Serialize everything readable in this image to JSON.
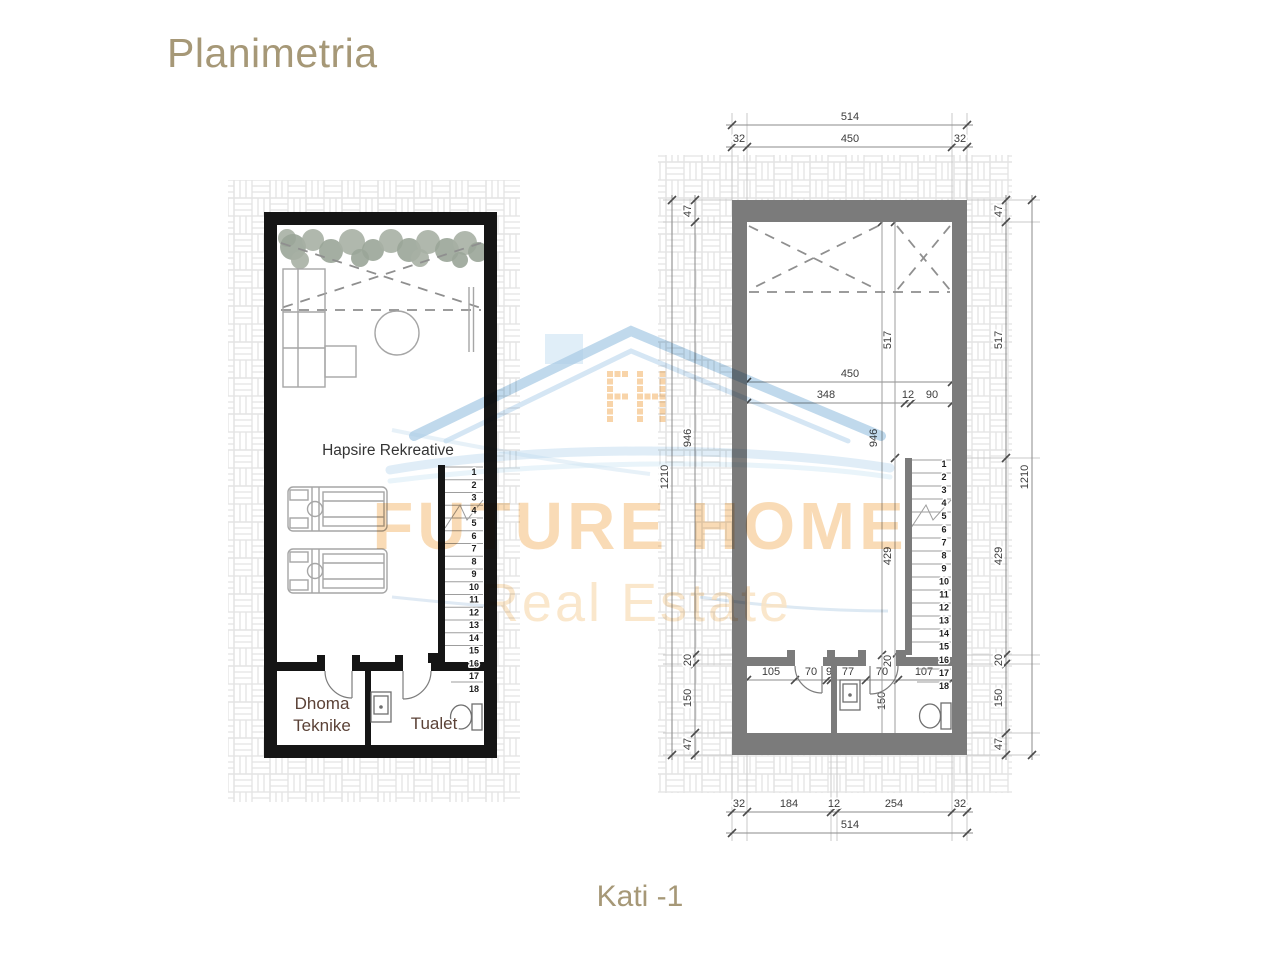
{
  "header": {
    "title": "Planimetria"
  },
  "footer": {
    "caption": "Kati -1"
  },
  "watermark": {
    "brand_line1": "FUTURE HOME",
    "brand_line2": "Real Estate",
    "logo": "fh-pixel-house-logo",
    "colors": {
      "orange": "#f5c48a",
      "blue": "#a3c7e3"
    }
  },
  "left_plan": {
    "room_main": "Hapsire Rekreative",
    "room_tech_line1": "Dhoma",
    "room_tech_line2": "Teknike",
    "room_toilet": "Tualet"
  },
  "stairs": {
    "numbers": [
      "1",
      "2",
      "3",
      "4",
      "5",
      "6",
      "7",
      "8",
      "9",
      "10",
      "11",
      "12",
      "13",
      "14",
      "15",
      "16",
      "17",
      "18"
    ]
  },
  "dims": {
    "top": {
      "total": "514",
      "segments": [
        "32",
        "450",
        "32"
      ]
    },
    "bottom": {
      "total": "514",
      "segments": [
        "32",
        "184",
        "12",
        "254",
        "32"
      ]
    },
    "left_side": {
      "total": "1210",
      "segments": [
        "47",
        "946",
        "20",
        "150",
        "47"
      ]
    },
    "right_side": {
      "total": "1210",
      "segments": [
        "47",
        "517",
        "429",
        "20",
        "150",
        "47"
      ]
    },
    "interior": {
      "width_total": "450",
      "width_segments": [
        "348",
        "12",
        "90"
      ],
      "height_946": "946",
      "height_517": "517",
      "height_429": "429",
      "height_20": "20",
      "height_150": "150",
      "bottom_segments": [
        "105",
        "70",
        "9",
        "77",
        "70",
        "107"
      ]
    }
  },
  "colors": {
    "accent": "#a69877",
    "wall_dark": "#151515",
    "wall_gray": "#7b7b7b"
  }
}
